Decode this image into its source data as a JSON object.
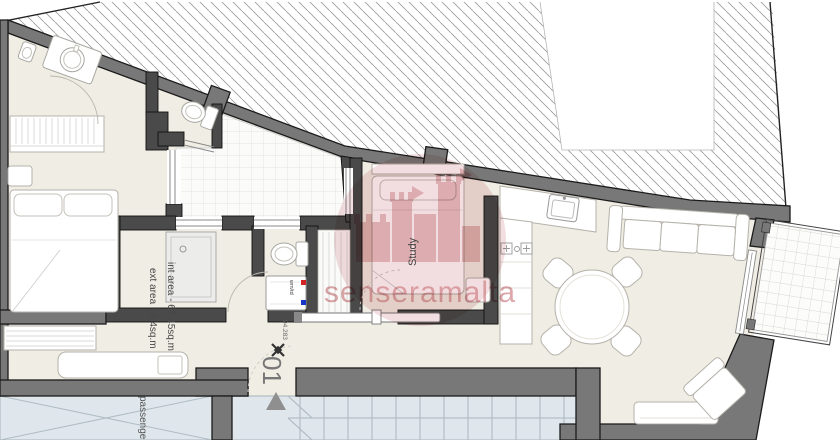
{
  "labels": {
    "study": "Study",
    "area_int": "int area - 67.45sq.m",
    "area_ext": "ext area - 9.4sq.m",
    "unit": "01",
    "level": "94.283",
    "wm": "wm/td",
    "lift": "passenger lift",
    "watermark": "senseramalta"
  },
  "colors": {
    "exterior_wall": "#787878",
    "interior_wall": "#4a4a4a",
    "floor": "#f0ede4",
    "common_area": "#dfe7ec",
    "watermark_pink": "#cf8186",
    "hot_water_red": "#d22222",
    "cold_water_blue": "#1636c8"
  }
}
